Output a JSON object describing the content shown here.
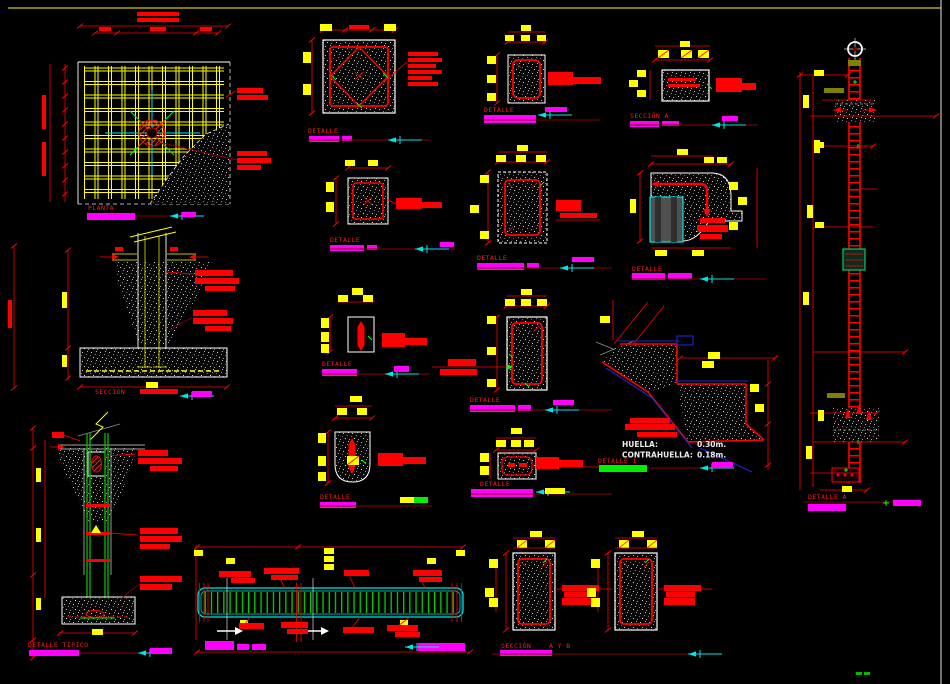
{
  "sheet": {
    "background": "#000000",
    "border_top_color": "#7f7f00",
    "border_right_color": "#ffffff"
  },
  "palette": {
    "red": "#ff0000",
    "dark_red": "#8b0000",
    "yellow": "#ffff00",
    "olive": "#808000",
    "magenta": "#ff00ff",
    "cyan": "#00e5e5",
    "green": "#00ff00",
    "rebar_green": "#00c000",
    "rebar_blue": "#2323d0",
    "white": "#ffffff"
  },
  "titles": {
    "plan": "PLANTA",
    "footing_section": "SECCION",
    "pile_detail": "DETALLE TIPICO",
    "col_section_sq": "DETALLE",
    "col_section_sm": "DETALLE",
    "beam_section_a": "SECCIÓN  A",
    "col_section_d": "DETALLE",
    "col_section_e": "DETALLE",
    "corner_detail": "DETALLE",
    "bar_detail": "DETALLE",
    "col_section_h": "DETALLE",
    "u_detail": "DETALLE",
    "plate_detail": "DETALLE",
    "stair_detail": "DETALLE 1",
    "section_ab": "SECCIÓN",
    "section_ab_sub": "A Y B",
    "column_elevation": "DETALLE A"
  },
  "stair": {
    "huella_label": "HUELLA:",
    "huella_value": "0.30m.",
    "contrahuella_label": "CONTRAHUELLA:",
    "contrahuella_value": "0.18m."
  }
}
